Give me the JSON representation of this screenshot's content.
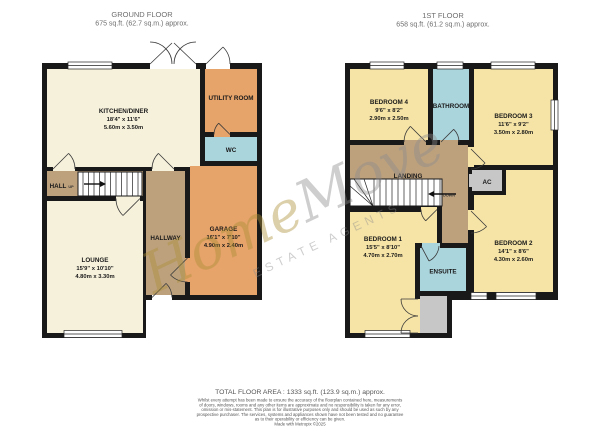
{
  "ground_floor": {
    "title": "GROUND FLOOR",
    "area": "675 sq.ft. (62.7 sq.m.) approx.",
    "rooms": {
      "kitchen": {
        "name": "KITCHEN/DINER",
        "imperial": "18'4\" x 11'6\"",
        "metric": "5.60m x 3.50m"
      },
      "utility": {
        "name": "UTILITY ROOM"
      },
      "wc": {
        "name": "WC"
      },
      "hall": {
        "name": "HALL",
        "stairs": "UP"
      },
      "hallway": {
        "name": "HALLWAY"
      },
      "lounge": {
        "name": "LOUNGE",
        "imperial": "15'9\" x 10'10\"",
        "metric": "4.80m x 3.30m"
      },
      "garage": {
        "name": "GARAGE",
        "imperial": "16'1\" x 7'10\"",
        "metric": "4.90m x 2.40m"
      }
    }
  },
  "first_floor": {
    "title": "1ST FLOOR",
    "area": "658 sq.ft. (61.2 sq.m.) approx.",
    "rooms": {
      "bedroom1": {
        "name": "BEDROOM 1",
        "imperial": "15'5\" x 8'10\"",
        "metric": "4.70m x 2.70m"
      },
      "bedroom2": {
        "name": "BEDROOM 2",
        "imperial": "14'1\" x 8'6\"",
        "metric": "4.30m x 2.60m"
      },
      "bedroom3": {
        "name": "BEDROOM 3",
        "imperial": "11'6\" x 9'2\"",
        "metric": "3.50m x 2.80m"
      },
      "bedroom4": {
        "name": "BEDROOM 4",
        "imperial": "9'6\" x 8'2\"",
        "metric": "2.90m x 2.50m"
      },
      "bathroom": {
        "name": "BATHROOM"
      },
      "ensuite": {
        "name": "ENSUITE"
      },
      "landing": {
        "name": "LANDING",
        "stairs": "DOWN"
      },
      "ac": {
        "name": "AC"
      }
    }
  },
  "watermark": {
    "brand_part1": "Home",
    "brand_part2": "Move",
    "tagline": "ESTATE AGENTS"
  },
  "footer": {
    "total": "TOTAL FLOOR AREA : 1333 sq.ft. (123.9 sq.m.) approx.",
    "disclaimer": [
      "Whilst every attempt has been made to ensure the accuracy of the floorplan contained here, measurements",
      "of doors, windows, rooms and any other items are approximate and no responsibility is taken for any error,",
      "omission or mis-statement. This plan is for illustrative purposes only and should be used as such by any",
      "prospective purchaser. The services, systems and appliances shown have not been tested and no guarantee",
      "as to their operability or efficiency can be given."
    ],
    "credit": "Made with Metropix ©2025"
  },
  "palette": {
    "room_cream": "#F6F1DB",
    "room_yellow": "#F6E4A6",
    "room_orange": "#E6A36A",
    "room_blue": "#ABD5DD",
    "hall_brown": "#BDA17D",
    "storage_gray": "#C7C7C7",
    "wall": "#191919",
    "watermark_gold": "#AC9036",
    "watermark_gray": "#8C8C8C"
  }
}
